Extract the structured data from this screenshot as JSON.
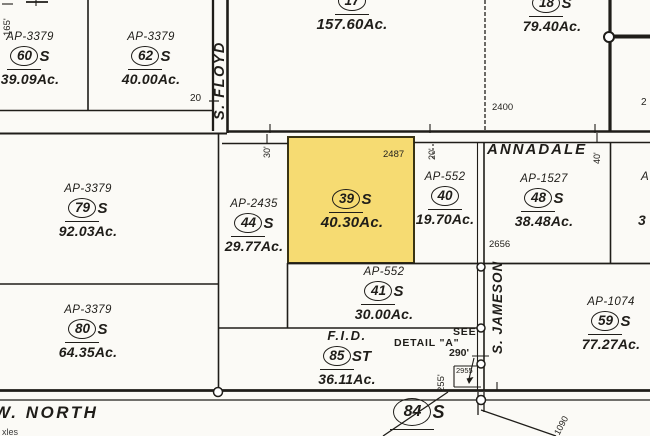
{
  "map": {
    "background": "#FBFAF6",
    "line_color": "#1F1D19",
    "highlight_fill": "#F6DB72",
    "highlight_border": "#3A3413"
  },
  "streets": {
    "floyd": "S. FLOYD",
    "annadale": "ANNADALE",
    "jameson": "S. JAMESON",
    "north": "W. NORTH"
  },
  "parcels": [
    {
      "apn": "AP-3379",
      "number": "60",
      "suffix": "S",
      "acreage": "39.09Ac."
    },
    {
      "apn": "AP-3379",
      "number": "62",
      "suffix": "S",
      "acreage": "40.00Ac."
    },
    {
      "number": "17",
      "acreage": "157.60Ac."
    },
    {
      "number": "18",
      "suffix": "S",
      "acreage": "79.40Ac."
    },
    {
      "apn": "AP-3379",
      "number": "79",
      "suffix": "S",
      "acreage": "92.03Ac."
    },
    {
      "apn": "AP-2435",
      "number": "44",
      "suffix": "S",
      "acreage": "29.77Ac."
    },
    {
      "number": "39",
      "suffix": "S",
      "acreage": "40.30Ac.",
      "highlighted": true
    },
    {
      "apn": "AP-552",
      "number": "40",
      "acreage": "19.70Ac."
    },
    {
      "apn": "AP-1527",
      "number": "48",
      "suffix": "S",
      "acreage": "38.48Ac."
    },
    {
      "apn": "AP-552",
      "number": "41",
      "suffix": "S",
      "acreage": "30.00Ac."
    },
    {
      "apn": "AP-3379",
      "number": "80",
      "suffix": "S",
      "acreage": "64.35Ac."
    },
    {
      "apn": "F.I.D.",
      "number": "85",
      "suffix": "ST",
      "acreage": "36.11Ac."
    },
    {
      "apn": "AP-1074",
      "number": "59",
      "suffix": "S",
      "acreage": "77.27Ac."
    },
    {
      "number": "84",
      "suffix": "S"
    }
  ],
  "dimensions": {
    "d165": "165'",
    "t20": "20",
    "t30": "30'",
    "t20b": "20'",
    "t40": "40'",
    "d290": "290'",
    "d255": "255'",
    "d1090": "1090"
  },
  "refs": {
    "r2400": "2400",
    "r2487": "2487",
    "r2656": "2656",
    "r2955": "2955"
  },
  "notes": {
    "see": "SEE",
    "detail": "DETAIL \"A\""
  },
  "partials": {
    "top_right": "2",
    "right_apn": "A",
    "right_acreage": "3",
    "bottom_left": "xles"
  }
}
